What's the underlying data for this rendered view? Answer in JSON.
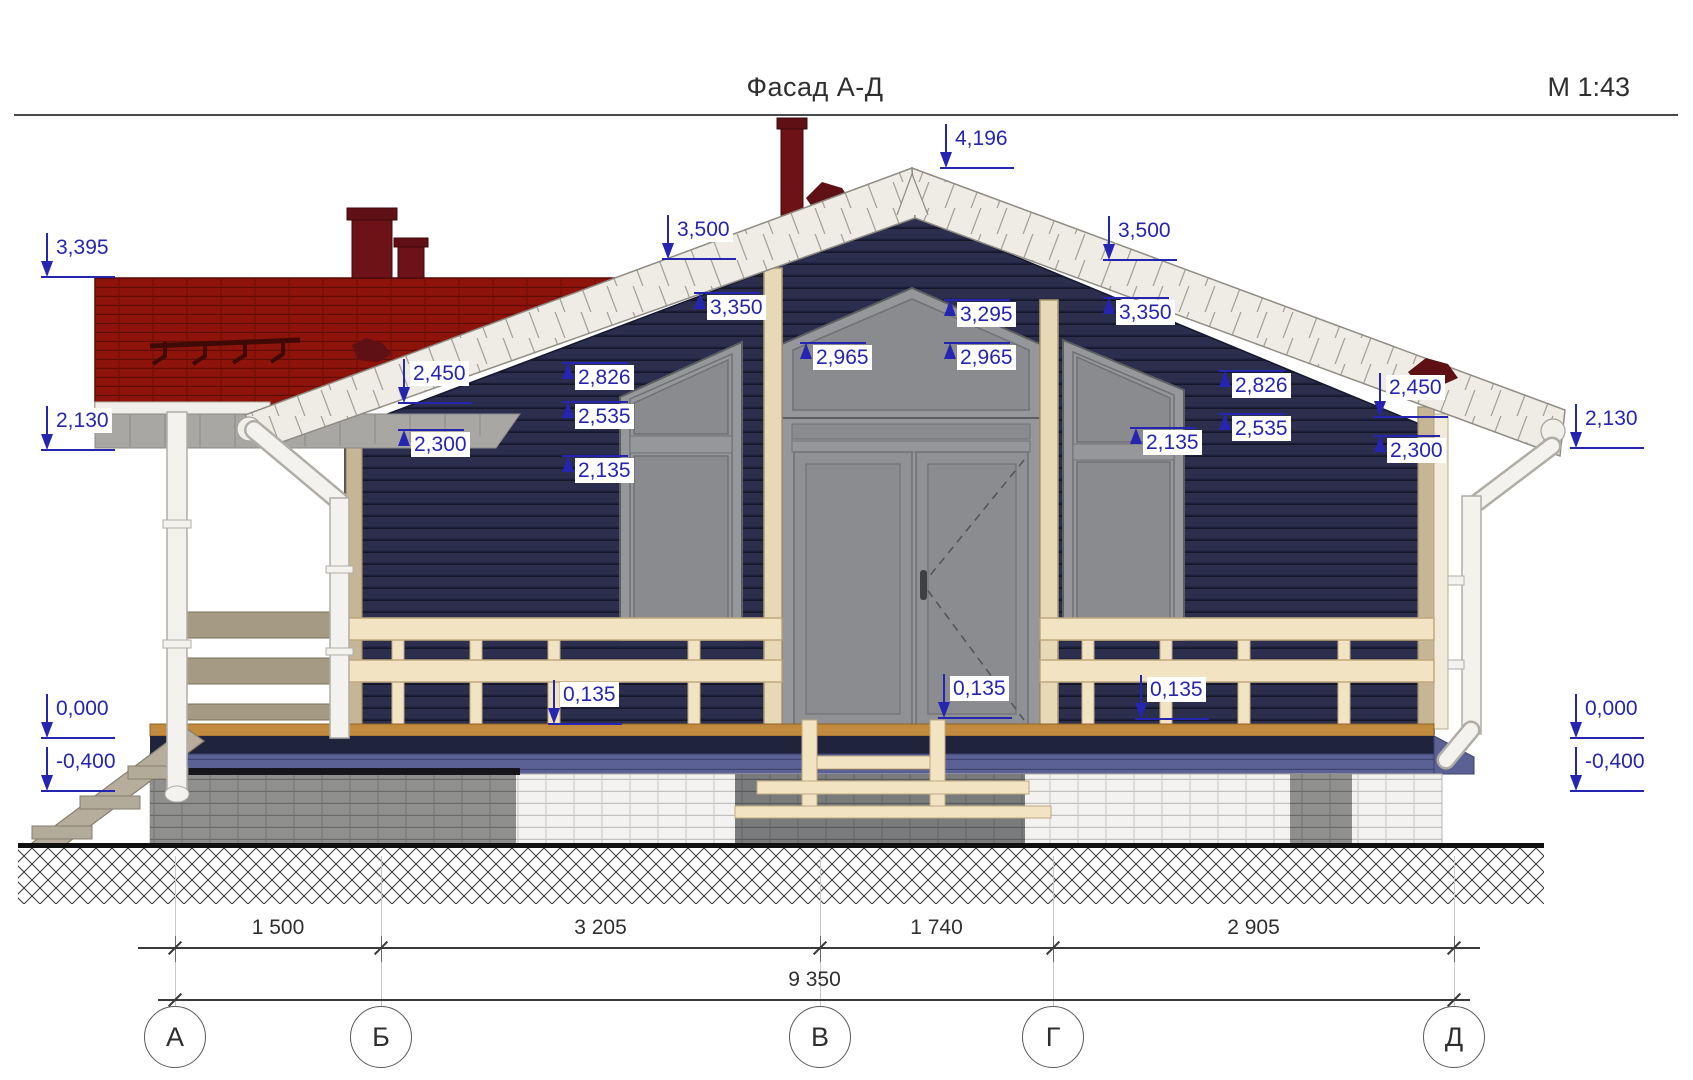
{
  "sheet": {
    "title": "Фасад А-Д",
    "scale": "М 1:43"
  },
  "drawing": {
    "type": "architectural-elevation",
    "zero_level_y": 738,
    "scale_px_per_m": 137
  },
  "marks": [
    {
      "v": "4,196",
      "x": 946,
      "y": 168,
      "d": "dn"
    },
    {
      "v": "3,395",
      "x": 47,
      "y": 277,
      "d": "dn"
    },
    {
      "v": "2,130",
      "x": 47,
      "y": 450,
      "d": "dn"
    },
    {
      "v": "3,500",
      "x": 668,
      "y": 259,
      "d": "dn"
    },
    {
      "v": "3,350",
      "x": 700,
      "y": 293,
      "d": "up"
    },
    {
      "v": "3,295",
      "x": 950,
      "y": 300,
      "d": "up"
    },
    {
      "v": "2,965",
      "x": 806,
      "y": 343,
      "d": "up"
    },
    {
      "v": "2,965",
      "x": 950,
      "y": 343,
      "d": "up"
    },
    {
      "v": "2,826",
      "x": 568,
      "y": 363,
      "d": "up"
    },
    {
      "v": "2,535",
      "x": 568,
      "y": 402,
      "d": "up"
    },
    {
      "v": "2,135",
      "x": 568,
      "y": 456,
      "d": "up"
    },
    {
      "v": "2,450",
      "x": 404,
      "y": 403,
      "d": "dn"
    },
    {
      "v": "2,300",
      "x": 404,
      "y": 430,
      "d": "up"
    },
    {
      "v": "3,500",
      "x": 1109,
      "y": 260,
      "d": "dn"
    },
    {
      "v": "3,350",
      "x": 1109,
      "y": 298,
      "d": "up"
    },
    {
      "v": "2,826",
      "x": 1225,
      "y": 371,
      "d": "up"
    },
    {
      "v": "2,535",
      "x": 1225,
      "y": 414,
      "d": "up"
    },
    {
      "v": "2,135",
      "x": 1136,
      "y": 428,
      "d": "up"
    },
    {
      "v": "2,450",
      "x": 1380,
      "y": 417,
      "d": "dn"
    },
    {
      "v": "2,300",
      "x": 1380,
      "y": 436,
      "d": "up"
    },
    {
      "v": "2,130",
      "x": 1576,
      "y": 448,
      "d": "dn"
    },
    {
      "v": "0,135",
      "x": 554,
      "y": 724,
      "d": "dn"
    },
    {
      "v": "0,135",
      "x": 944,
      "y": 718,
      "d": "dn"
    },
    {
      "v": "0,135",
      "x": 1141,
      "y": 719,
      "d": "dn"
    },
    {
      "v": "0,000",
      "x": 47,
      "y": 738,
      "d": "dn"
    },
    {
      "v": "-0,400",
      "x": 47,
      "y": 791,
      "d": "dn"
    },
    {
      "v": "0,000",
      "x": 1576,
      "y": 738,
      "d": "dn"
    },
    {
      "v": "-0,400",
      "x": 1576,
      "y": 791,
      "d": "dn"
    }
  ],
  "dims": {
    "segments": [
      {
        "label": "1 500",
        "x1": 175,
        "x2": 381
      },
      {
        "label": "3 205",
        "x1": 381,
        "x2": 820
      },
      {
        "label": "1 740",
        "x1": 820,
        "x2": 1053
      },
      {
        "label": "2 905",
        "x1": 1053,
        "x2": 1454
      }
    ],
    "total": {
      "label": "9 350",
      "x1": 175,
      "x2": 1454
    }
  },
  "axes": [
    {
      "label": "А",
      "x": 175
    },
    {
      "label": "Б",
      "x": 381
    },
    {
      "label": "В",
      "x": 820
    },
    {
      "label": "Г",
      "x": 1053
    },
    {
      "label": "Д",
      "x": 1454
    }
  ],
  "colors": {
    "marker_blue": "#2525b2",
    "wall_navy": "#2b2e4c",
    "roof_red": "#8e130b",
    "fascia_white": "#eeece4",
    "rail_cream": "#f2e4c2",
    "post_tan": "#e7d8b6",
    "skirt_slate": "#5b6095",
    "window_gray": "#95979a"
  }
}
